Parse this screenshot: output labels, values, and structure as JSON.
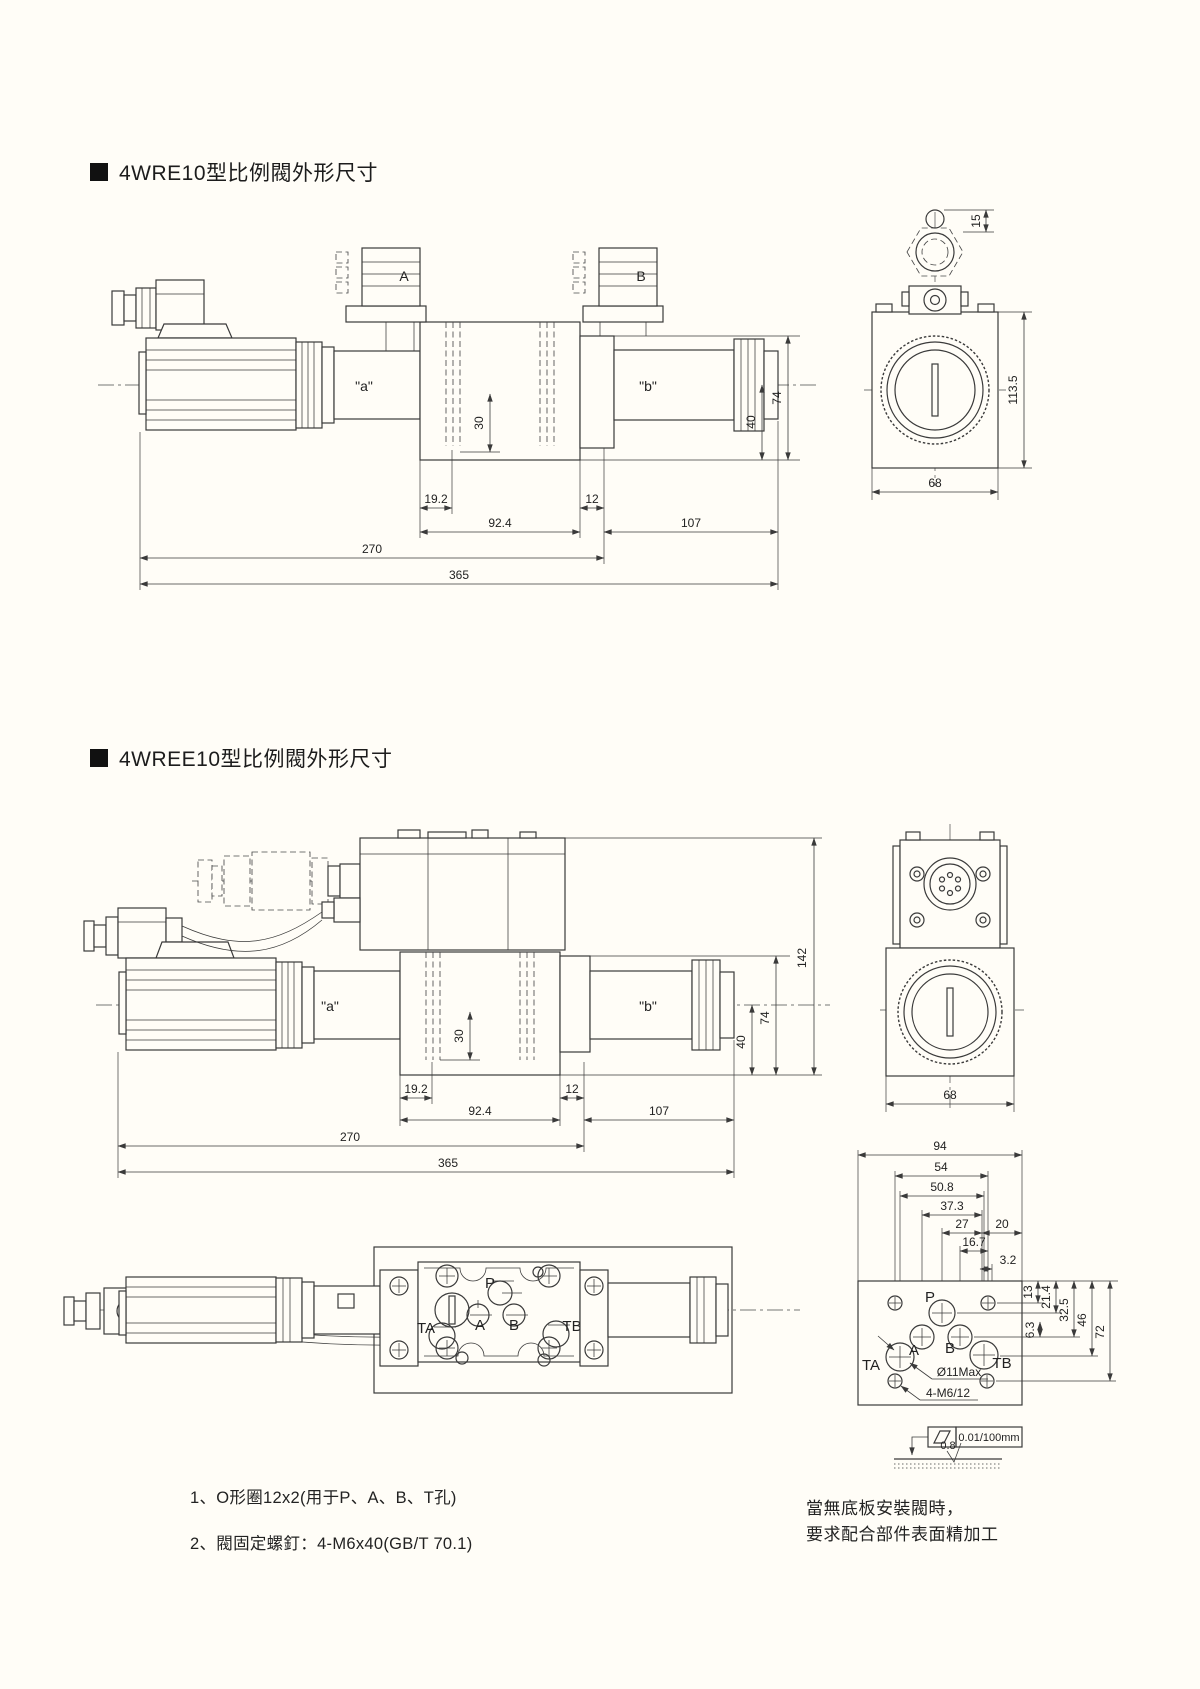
{
  "page": {
    "background": "#fffdf7",
    "line_color": "#3a3a3a"
  },
  "sections": {
    "s1": {
      "title": "4WRE10型比例閥外形尺寸",
      "pos_a": "\"a\"",
      "pos_b": "\"b\"",
      "sol_a": "A",
      "sol_b": "B",
      "dims": {
        "w19_2": "19.2",
        "w92_4": "92.4",
        "w12": "12",
        "w107": "107",
        "w270": "270",
        "w365": "365",
        "h30": "30",
        "h40": "40",
        "h74": "74",
        "h15": "15",
        "h113_5": "113.5",
        "w68": "68"
      }
    },
    "s2": {
      "title": "4WREE10型比例閥外形尺寸",
      "pos_a": "\"a\"",
      "pos_b": "\"b\"",
      "dims": {
        "w19_2": "19.2",
        "w92_4": "92.4",
        "w12": "12",
        "w107": "107",
        "w270": "270",
        "w365": "365",
        "h30": "30",
        "h40": "40",
        "h74": "74",
        "h142": "142",
        "w68": "68"
      }
    },
    "bottom_view": {
      "ports": {
        "p": "P",
        "a": "A",
        "b": "B",
        "ta": "TA",
        "tb": "TB"
      }
    },
    "mounting": {
      "dims": {
        "w94": "94",
        "w54": "54",
        "w50_8": "50.8",
        "w37_3": "37.3",
        "w27": "27",
        "w20": "20",
        "w16_7": "16.7",
        "w3_2": "3.2",
        "h13": "13",
        "h21_4": "21.4",
        "h6_3": "6.3",
        "h32_5": "32.5",
        "h46": "46",
        "h72": "72"
      },
      "ports": {
        "p": "P",
        "a": "A",
        "b": "B",
        "ta": "TA",
        "tb": "TB"
      },
      "callout_hole": "Ø11Max",
      "callout_thread": "4-M6/12",
      "flatness_value": "0.01/100mm",
      "roughness": "0.8"
    },
    "notes": {
      "n1": "1、O形圈12x2(用于P、A、B、T孔)",
      "n2": "2、閥固定螺釘：4-M6x40(GB/T 70.1)",
      "r1": "當無底板安裝閥時，",
      "r2": "要求配合部件表面精加工"
    }
  }
}
